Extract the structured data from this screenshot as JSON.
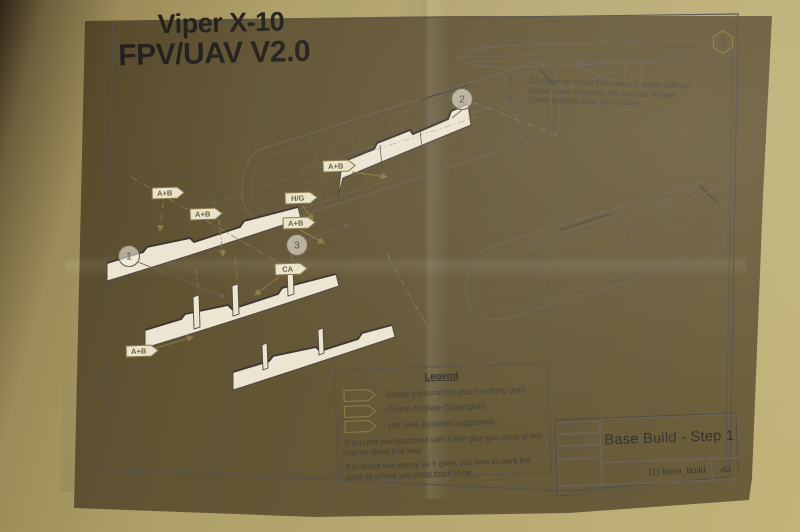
{
  "sheet": {
    "title_line1": "Viper X-10",
    "title_line2": "FPV/UAV V2.0",
    "instructions": [
      {
        "num": "1.",
        "text": "CA togetther subfin then epoxy in subfin stiffener"
      },
      {
        "num": "2.",
        "text": "Epoxy subfin assembly into one half of base"
      },
      {
        "num": "3.",
        "text": "Epoxy together other half of base"
      }
    ],
    "legend": {
      "title": "Legend",
      "entries": [
        {
          "flag": "A+B",
          "text": "- Epoxy (optional hot glue low temp gun)"
        },
        {
          "flag": "CA",
          "text": "- Cyano Acrylate (Superglue)"
        },
        {
          "flag": "H/G",
          "text": "- Hot Glue (optional suggested)"
        }
      ],
      "note1": "If you are well practiced with a Hot glue gun most of this can be done that way.",
      "note2": "If in doubt use epoxy as it gives you time to work the parts to where you need them to be"
    },
    "title_block": {
      "drawn_by_label": "Drawn by:",
      "drawn_by": "Dr M.J.Black",
      "checked_by_label": "Checked by:",
      "title_label": "TITLE",
      "title": "Base Build - Step 1",
      "drawing_label": "Drawing (2/16)",
      "drawing_name": "(1) base_build",
      "paper_size": "A3",
      "footer_left": "Green Air Designs / Sigma Condor Solutions (c) 2012",
      "footer_right": "SHEET 1 OF 5"
    }
  },
  "diagram": {
    "balloons": [
      "1",
      "2",
      "3"
    ],
    "hex_badge": "1",
    "flags": [
      "A+B",
      "A+B",
      "H/G",
      "A+B",
      "CA",
      "A+B",
      "A+B"
    ]
  },
  "colors": {
    "desk": "#b3a46f",
    "paper": "#ece5d3",
    "ink": "#6b6254",
    "flag_accent": "#8a7b48"
  }
}
